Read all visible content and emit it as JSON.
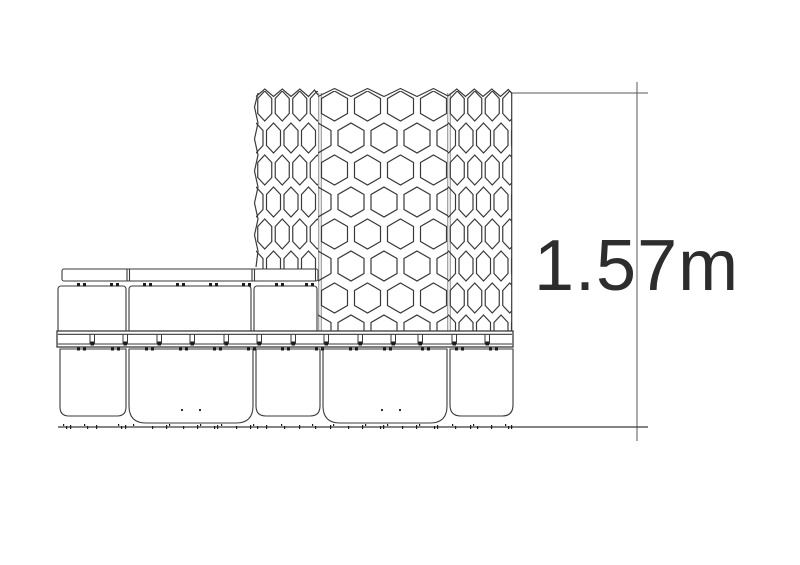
{
  "dimension": {
    "label": "1.57m"
  },
  "colors": {
    "line": "#3a3a3a",
    "seam": "#9b9b9b",
    "hatch": "#1c1c1c",
    "dimension": "#5a5a5a",
    "label": "#2d2d2d",
    "surface": "#ffffff"
  }
}
